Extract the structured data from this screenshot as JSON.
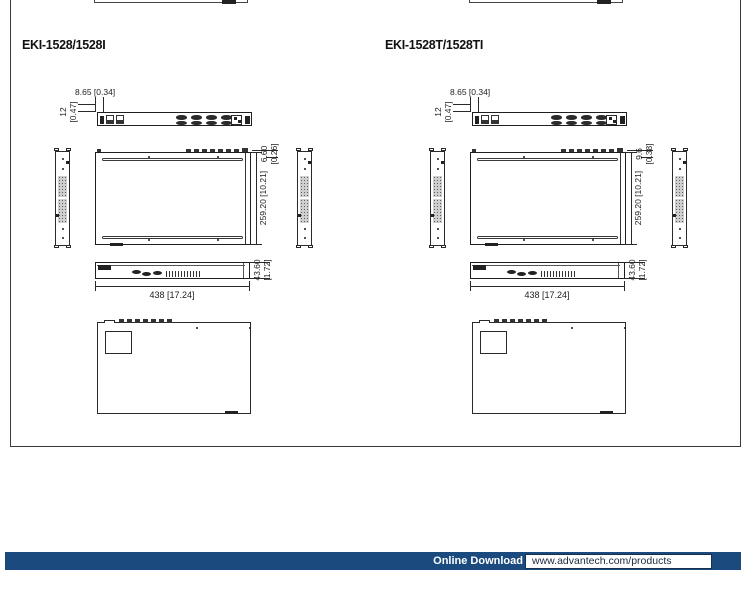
{
  "panels": [
    {
      "title": "EKI-1528/1528I",
      "dim_offset": "8.65 [0.34]",
      "dim_h_mm": "12",
      "dim_h_in": "[0.47]",
      "dim_depth": "259.20 [10.21]",
      "dim_lip_mm": "6.60",
      "dim_lip_in": "[0.26]",
      "dim_width": "438 [17.24]",
      "dim_height_mm": "43.60",
      "dim_height_in": "[1.72]"
    },
    {
      "title": "EKI-1528T/1528TI",
      "dim_offset": "8.65 [0.34]",
      "dim_h_mm": "12",
      "dim_h_in": "[0.47]",
      "dim_depth": "259.20 [10.21]",
      "dim_lip_mm": "9.6",
      "dim_lip_in": "[0.38]",
      "dim_width": "438 [17.24]",
      "dim_height_mm": "43.60",
      "dim_height_in": "[1.72]"
    }
  ],
  "footer": {
    "download_label": "Online Download",
    "download_url": "www.advantech.com/products",
    "bar_color": "#1b4b7e"
  }
}
